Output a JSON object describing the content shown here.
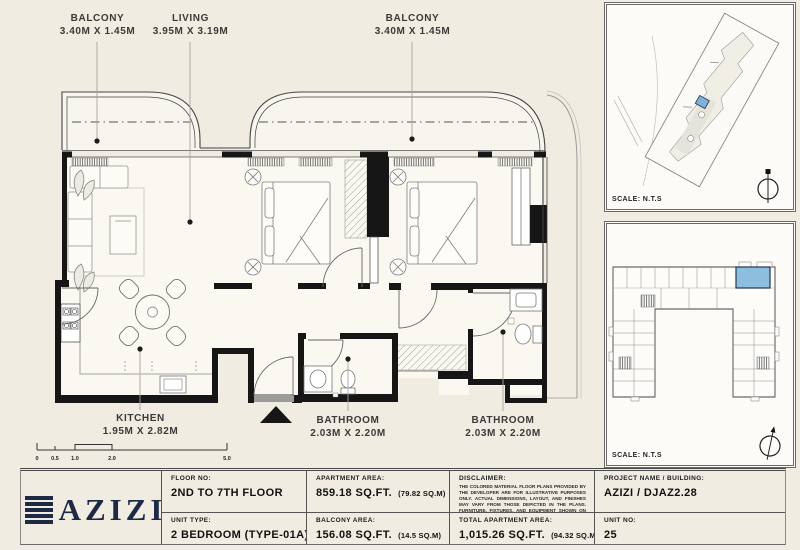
{
  "colors": {
    "background": "#f0ece1",
    "paper": "#faf8f1",
    "wall_black": "#161616",
    "unit_highlight_blue": "#8cbede",
    "logo_navy": "#1d2945"
  },
  "plan": {
    "rooms": {
      "balcony_left": {
        "name": "BALCONY",
        "dims": "3.40M X 1.45M"
      },
      "living": {
        "name": "LIVING",
        "dims": "3.95M X 3.19M"
      },
      "balcony_right": {
        "name": "BALCONY",
        "dims": "3.40M X 1.45M"
      },
      "kitchen": {
        "name": "KITCHEN",
        "dims": "1.95M X 2.82M"
      },
      "bathroom_1": {
        "name": "BATHROOM",
        "dims": "2.03M X 2.20M"
      },
      "bathroom_2": {
        "name": "BATHROOM",
        "dims": "2.03M X 2.20M"
      }
    },
    "scale_bar": {
      "ticks": [
        "0",
        "0.5",
        "1.0",
        "2.0",
        "5.0"
      ]
    }
  },
  "panels": {
    "site_map": {
      "scale_note": "SCALE: N.T.S"
    },
    "key_plan": {
      "scale_note": "SCALE: N.T.S"
    }
  },
  "footer": {
    "brand": "AZIZI",
    "cells": {
      "floor": {
        "label": "FLOOR NO:",
        "value": "2ND TO 7TH FLOOR"
      },
      "unit_type": {
        "label": "UNIT TYPE:",
        "value": "2 BEDROOM (TYPE-01A)"
      },
      "apartment_area": {
        "label": "APARTMENT AREA:",
        "value": "859.18 SQ.FT.",
        "alt": "(79.82 SQ.M)"
      },
      "balcony_area": {
        "label": "BALCONY AREA:",
        "value": "156.08 SQ.FT.",
        "alt": "(14.5 SQ.M)"
      },
      "disclaimer": {
        "label": "DISCLAIMER:",
        "text": "THE COLORED MATERIAL FLOOR PLANS PROVIDED BY THE DEVELOPER ARE FOR ILLUSTRATIVE PURPOSES ONLY. ACTUAL DIMENSIONS, LAYOUT, AND FINISHES MAY VARY FROM THOSE DEPICTED IN THE PLANS. FURNITURE, FIXTURES, AND EQUIPMENT SHOWN ON THE PLANS ARE FOR DECORATIVE PURPOSES ONLY AND ARE NOT INCLUDED IN THE PURCHASE OR LEASE OF THE PROPERTY. THE DEVELOPER RESERVES THE RIGHT TO MAKE MODIFICATIONS, REVISIONS, AND CHANGES TO THE FLOOR PLANS, SPECIFICATIONS, AND FEATURES WITHOUT PRIOR NOTICE."
      },
      "total_area": {
        "label": "TOTAL APARTMENT AREA:",
        "value": "1,015.26 SQ.FT.",
        "alt": "(94.32 SQ.M)"
      },
      "project": {
        "label": "PROJECT NAME / BUILDING:",
        "value": "AZIZI / DJAZ2.28"
      },
      "unit_no": {
        "label": "UNIT NO:",
        "value": "25"
      }
    }
  }
}
